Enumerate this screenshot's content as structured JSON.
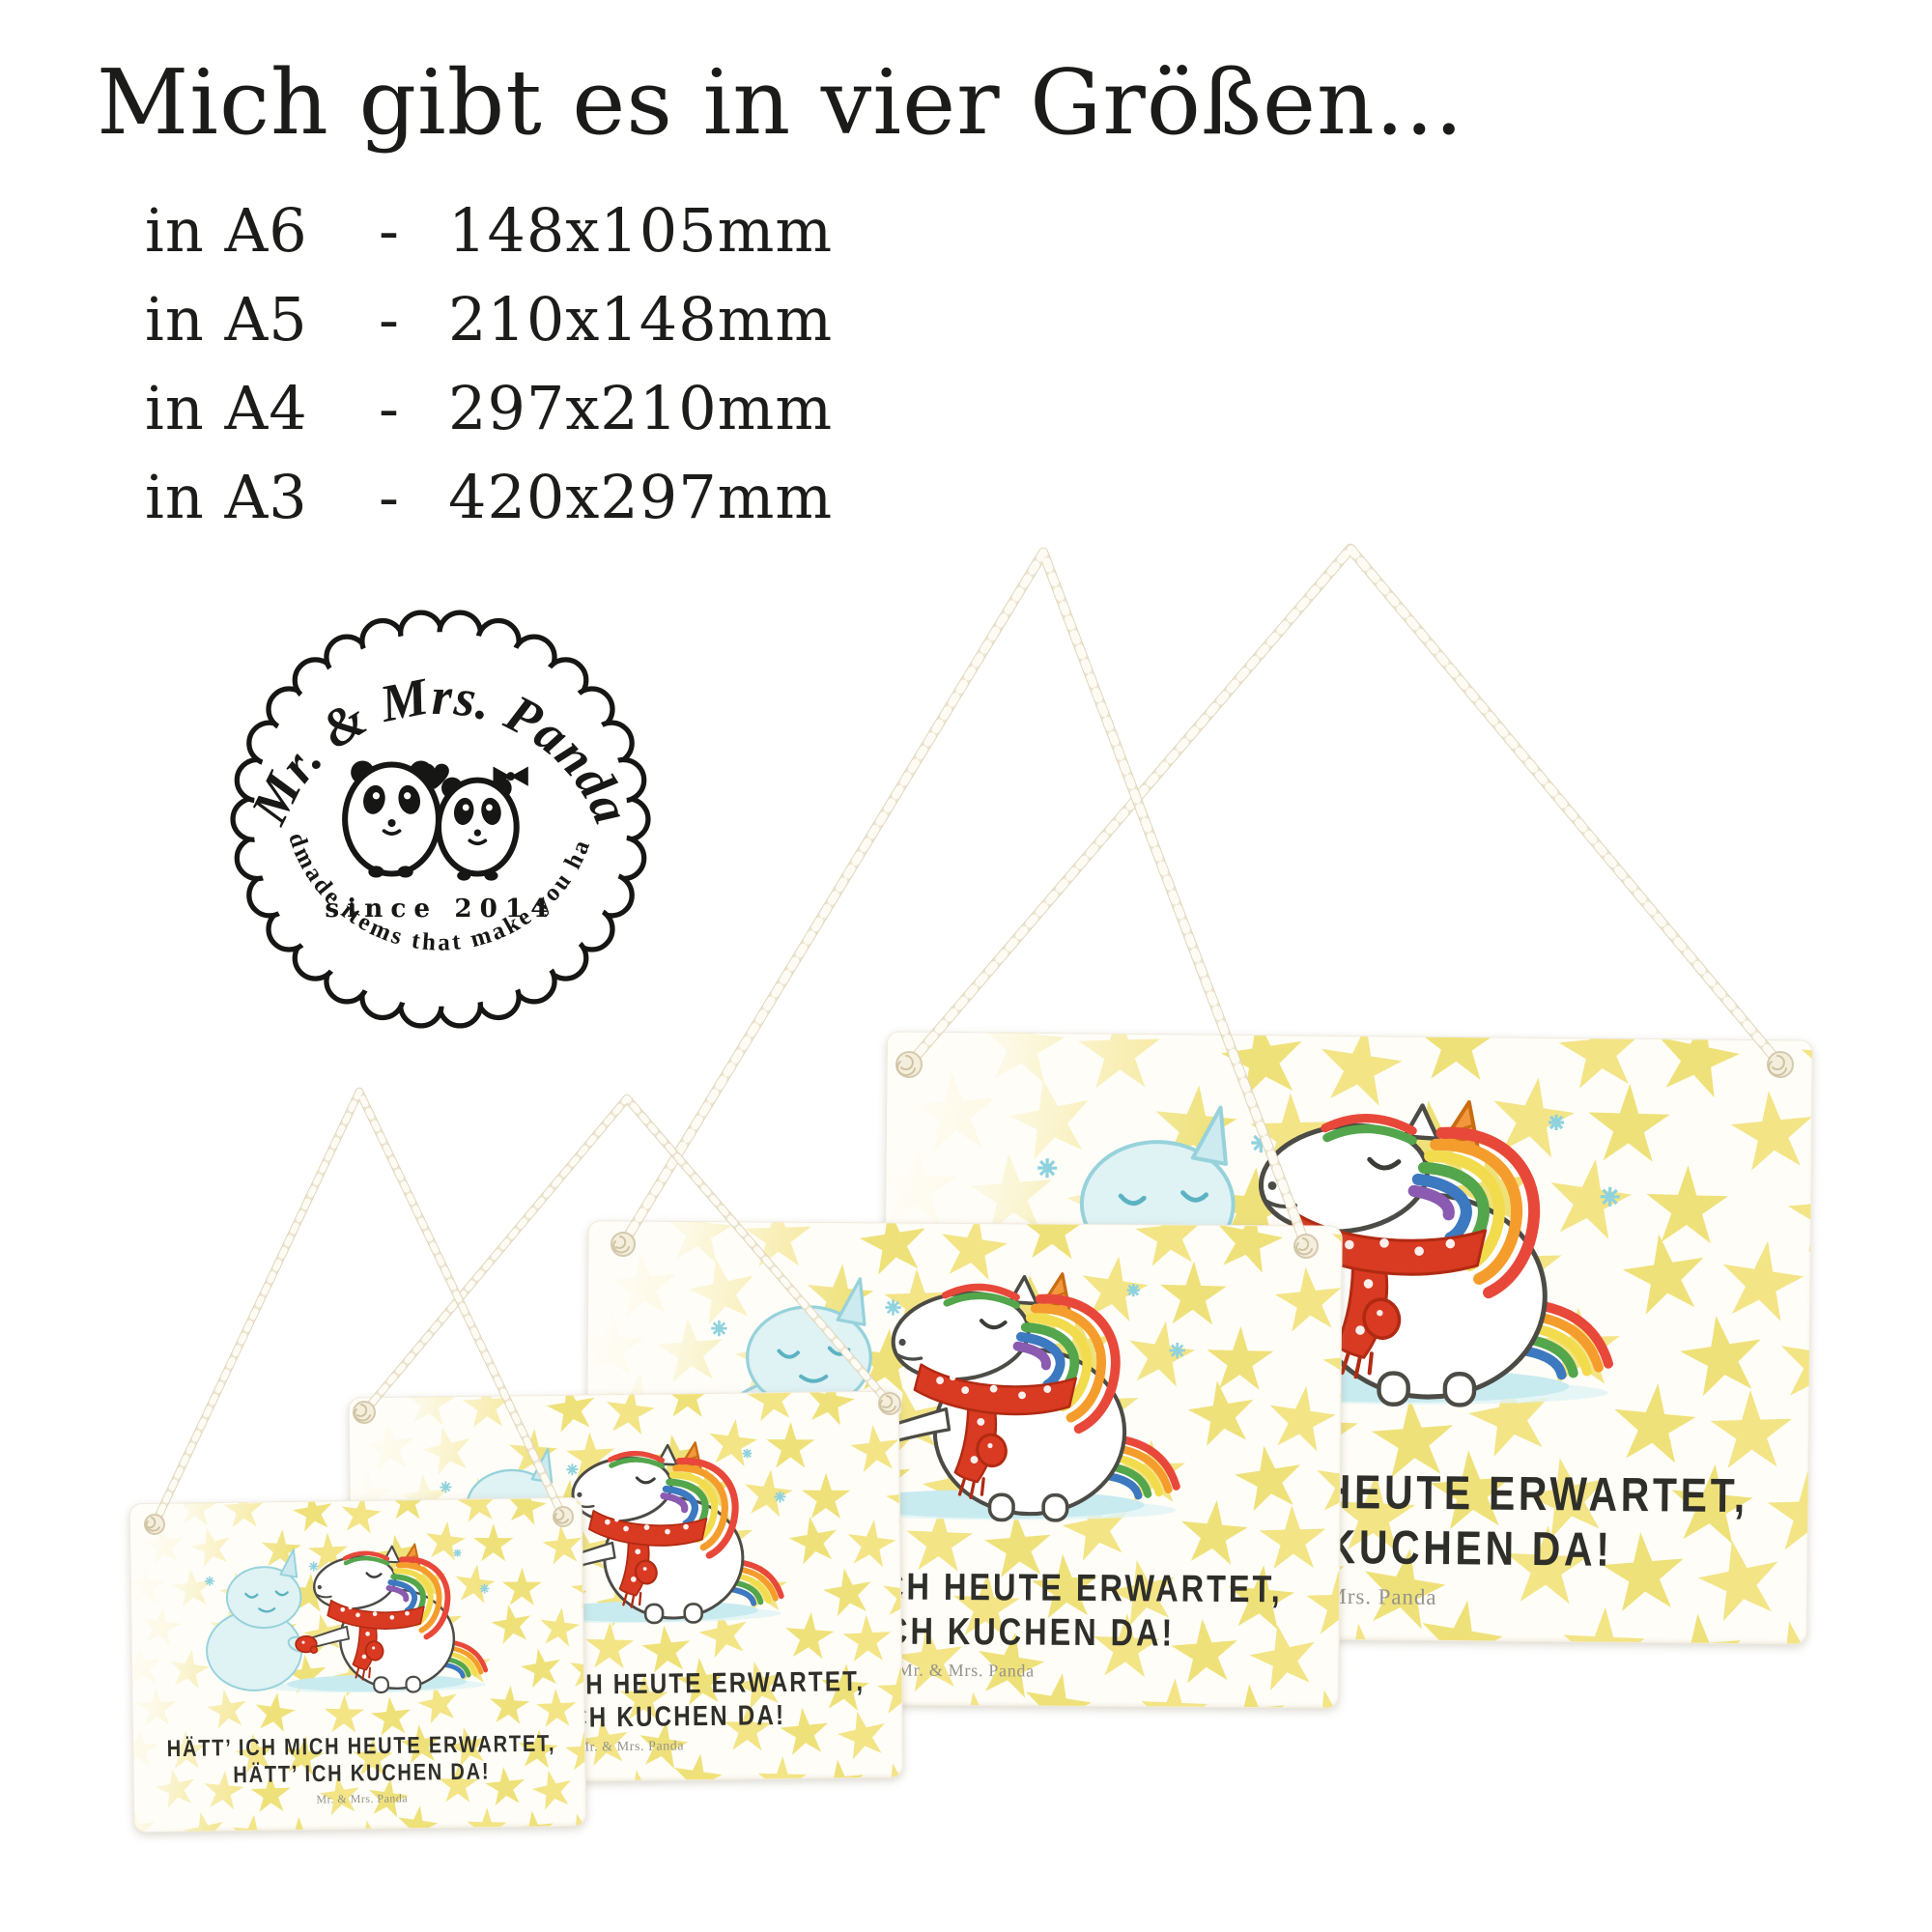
{
  "header": {
    "title": "Mich gibt es in vier Größen...",
    "sizes": [
      {
        "label": "in A6",
        "dash": "-",
        "dims": "148x105mm"
      },
      {
        "label": "in A5",
        "dash": "-",
        "dims": "210x148mm"
      },
      {
        "label": "in A4",
        "dash": "-",
        "dims": "297x210mm"
      },
      {
        "label": "in A3",
        "dash": "-",
        "dims": "420x297mm"
      }
    ]
  },
  "badge": {
    "brand": "Mr. & Mrs. Panda",
    "since": "since 2014",
    "tagline": "Handmade items that make you happy!"
  },
  "signs": {
    "quote_line1": "HÄTT’ ICH MICH HEUTE ERWARTET,",
    "quote_line2": "HÄTT’ ICH KUCHEN DA!",
    "signature": "Mr. & Mrs. Panda"
  },
  "colors": {
    "star_yellow": "#f2e27c",
    "scarf_red": "#d93a22",
    "ice_blue": "#c8ebf0",
    "snowman_blue": "#dff2f4",
    "rope_cream": "#ece4cf",
    "text_black": "#1c1c1a"
  }
}
